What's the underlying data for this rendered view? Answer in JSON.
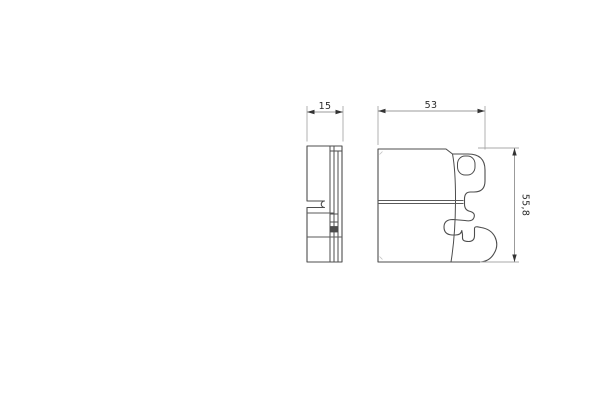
{
  "drawing": {
    "description": "brake pad technical drawing, side view and front view",
    "colors": {
      "background": "#ffffff",
      "part_outline": "#4d4d4d",
      "dimension_lines": "#9b9b9b",
      "arrows": "#333333",
      "text": "#2b2b2b"
    },
    "views": [
      {
        "id": "side-view"
      },
      {
        "id": "front-view"
      }
    ],
    "dimension_labels": {
      "side_width": "15",
      "front_width": "53",
      "front_height": "55,8"
    }
  }
}
